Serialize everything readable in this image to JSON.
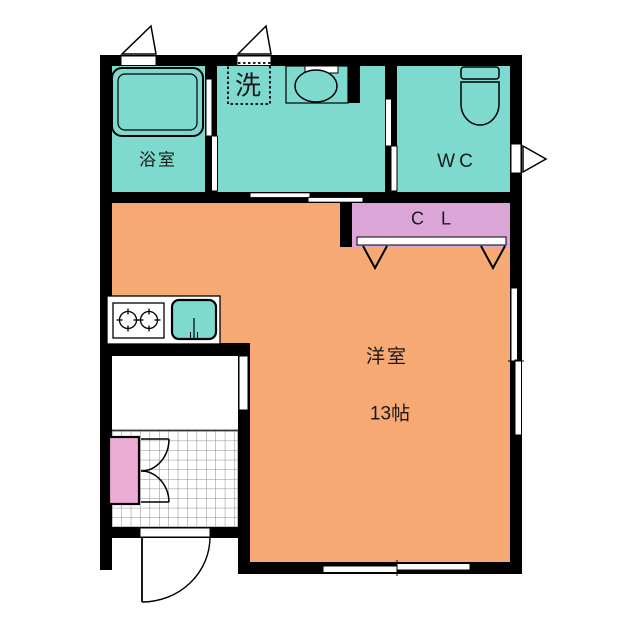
{
  "colors": {
    "wall": "#000000",
    "wet_area": "#7EDACE",
    "main_room": "#F6A973",
    "closet": "#DBA5D7",
    "shoe_cabinet": "#ECACD5",
    "tile_line": "#8a8a8a",
    "background": "#FFFFFF"
  },
  "labels": {
    "bathroom": "浴室",
    "laundry": "洗",
    "toilet": "WC",
    "closet": "C L",
    "room_name": "洋室",
    "room_size": "13帖"
  }
}
